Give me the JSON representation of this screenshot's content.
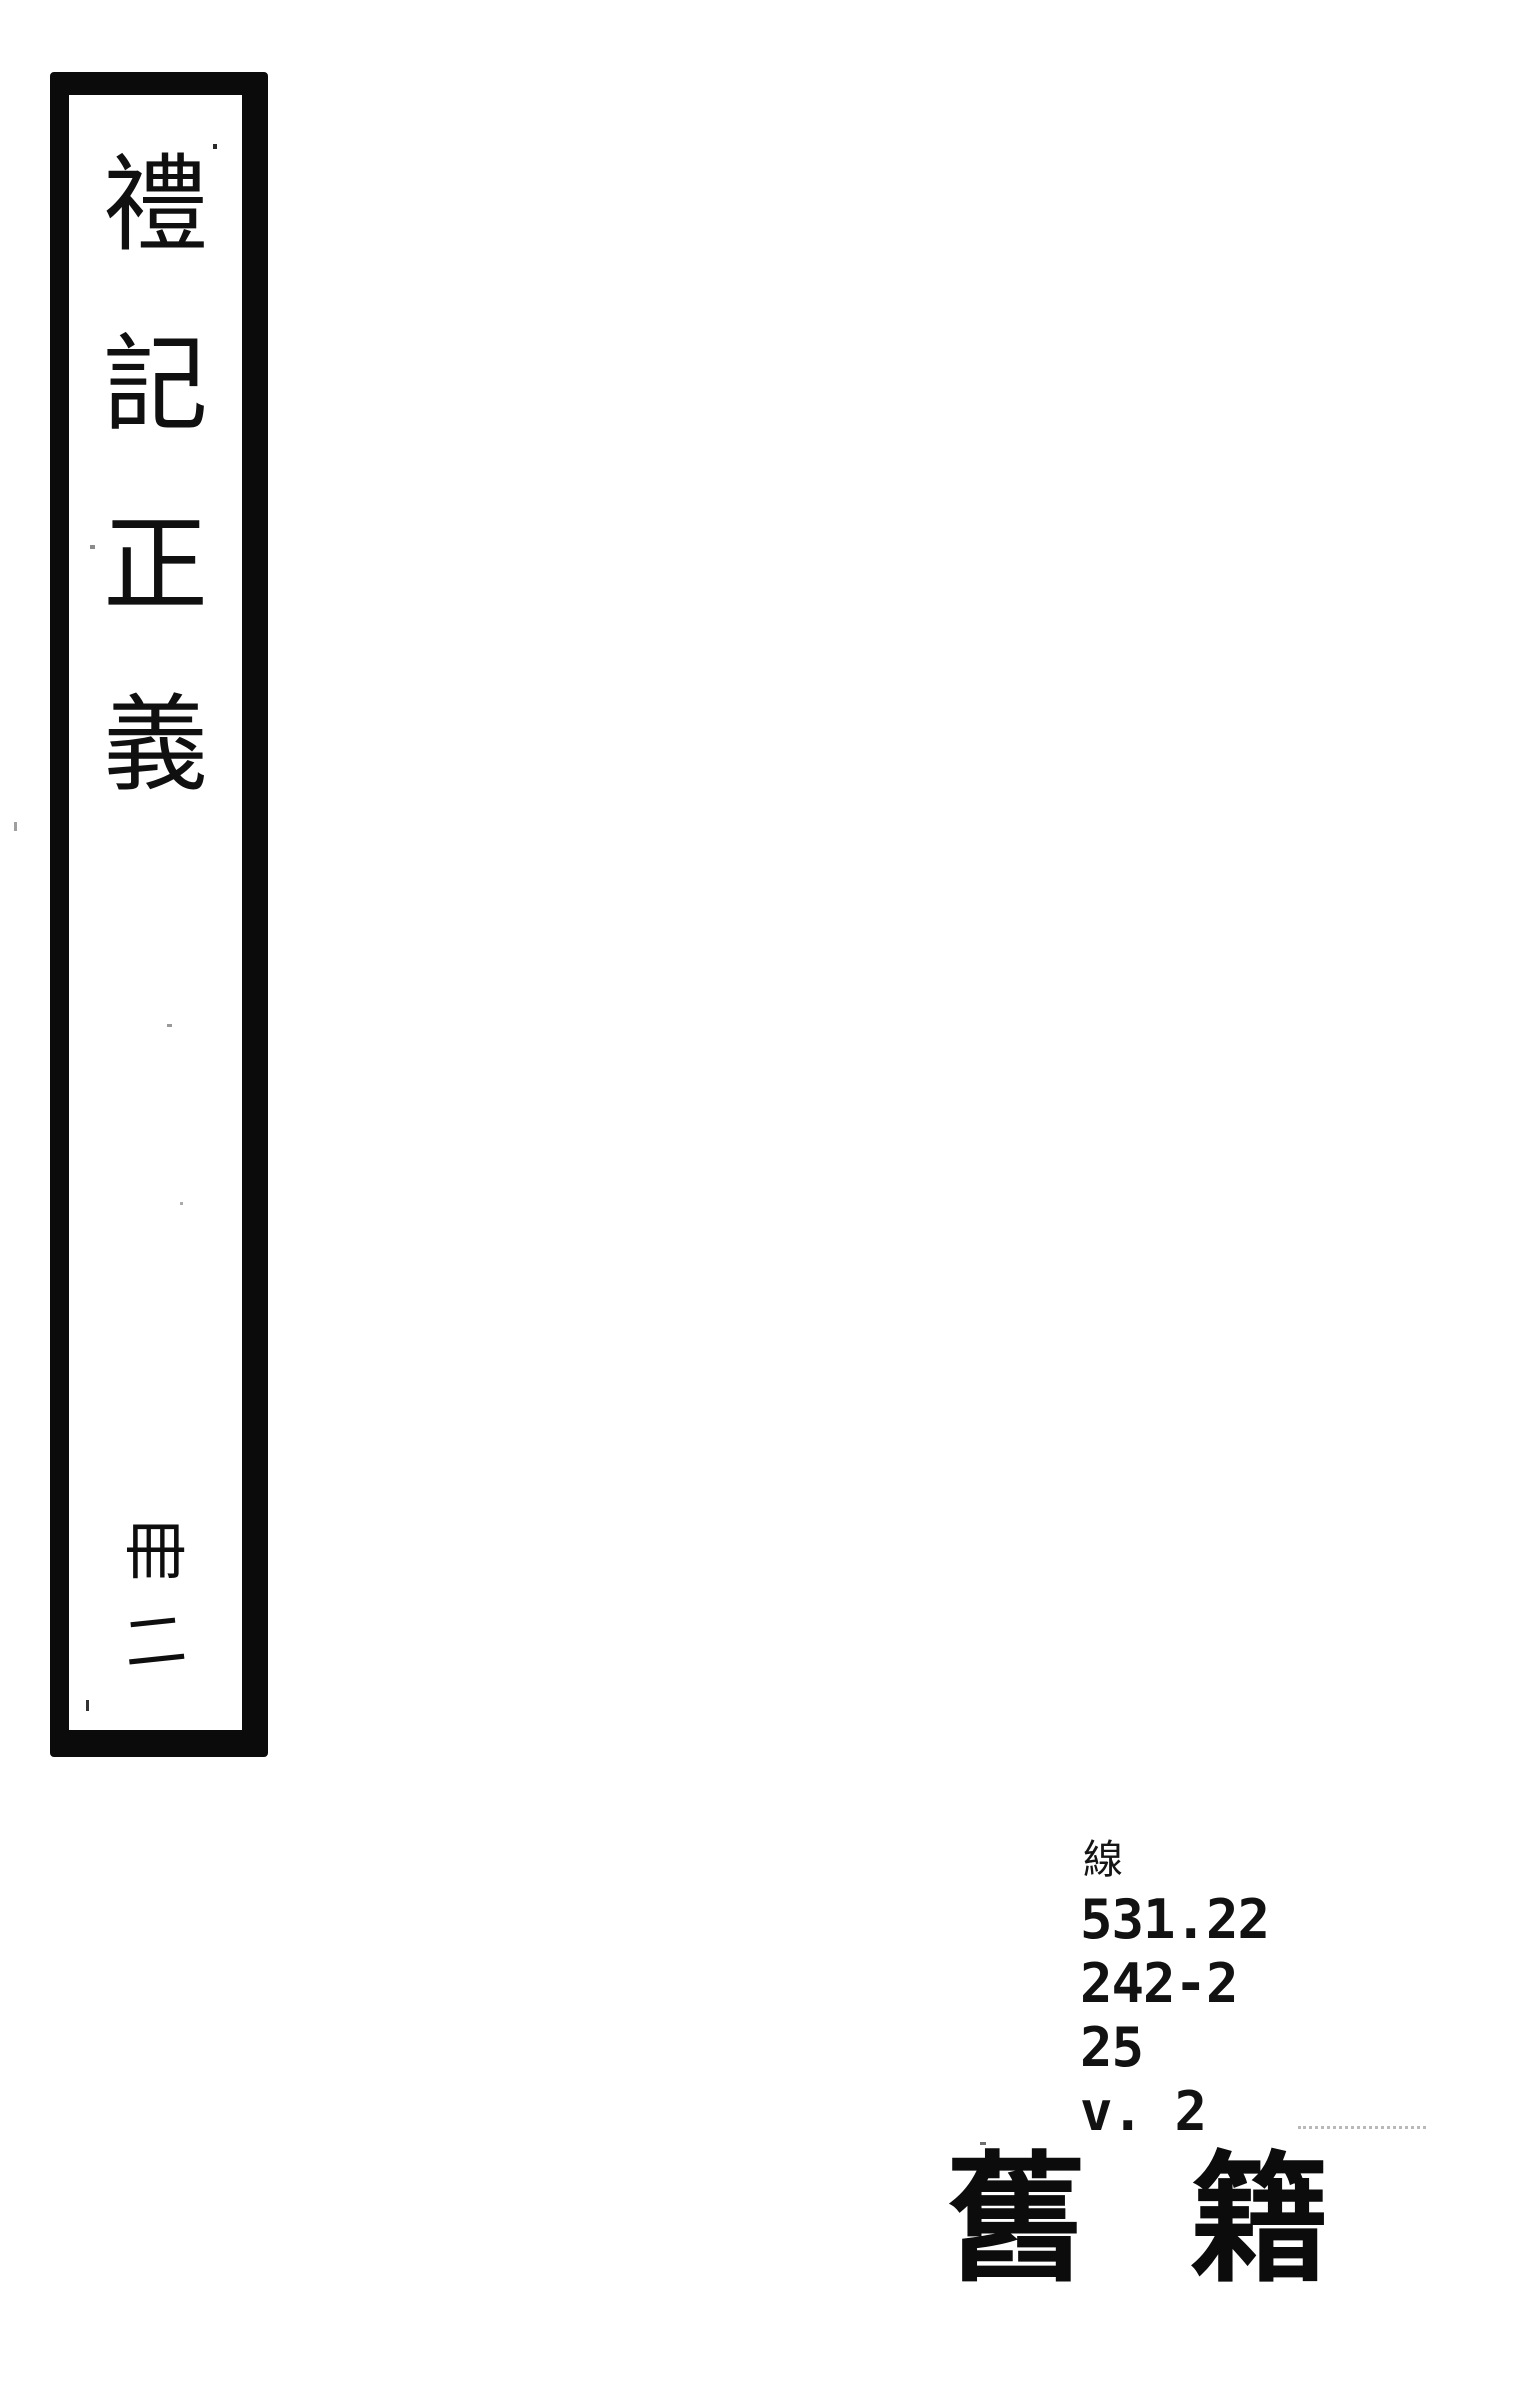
{
  "colors": {
    "ink": "#0b0b0b",
    "paper": "#ffffff",
    "faint_artifact": "#b9b9b9"
  },
  "spine_label": {
    "title_full": "禮記正義",
    "title_chars": [
      "禮",
      "記",
      "正",
      "義"
    ],
    "volume_full": "冊二",
    "volume_chars": [
      "冊",
      "二"
    ]
  },
  "call_number": {
    "binding": "線",
    "lines": [
      "531.22",
      "242-2",
      "25",
      "v. 2"
    ]
  },
  "collection_label": {
    "full": "舊籍",
    "chars": [
      "舊",
      "籍"
    ]
  }
}
